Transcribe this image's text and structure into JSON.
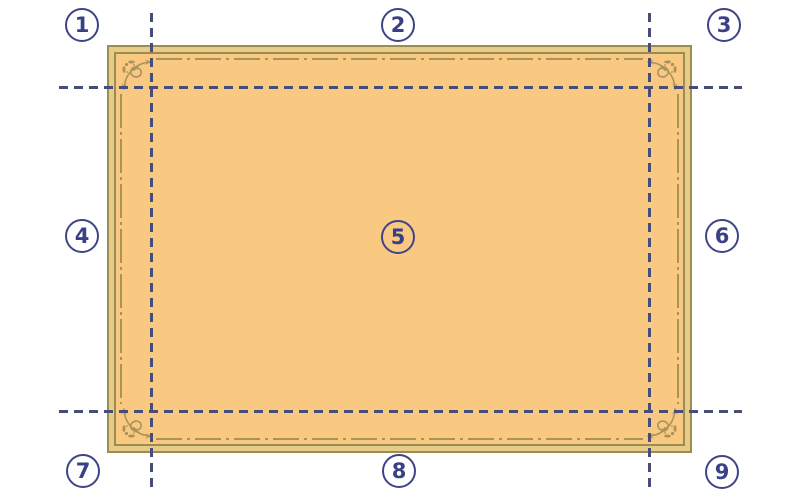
{
  "diagram": {
    "type": "nine-slice-scaling-guide",
    "regions": [
      {
        "label": "1",
        "position": "top-left"
      },
      {
        "label": "2",
        "position": "top-center"
      },
      {
        "label": "3",
        "position": "top-right"
      },
      {
        "label": "4",
        "position": "middle-left"
      },
      {
        "label": "5",
        "position": "center"
      },
      {
        "label": "6",
        "position": "middle-right"
      },
      {
        "label": "7",
        "position": "bottom-left"
      },
      {
        "label": "8",
        "position": "bottom-center"
      },
      {
        "label": "9",
        "position": "bottom-right"
      }
    ],
    "colors": {
      "background": "#ffffff",
      "panel_fill": "#f9c981",
      "frame_band": "#e7cc88",
      "frame_line": "#9c8b53",
      "ornament": "#a8935c",
      "guide_dash": "#474c79",
      "marker_navy": "#3f4488"
    }
  }
}
